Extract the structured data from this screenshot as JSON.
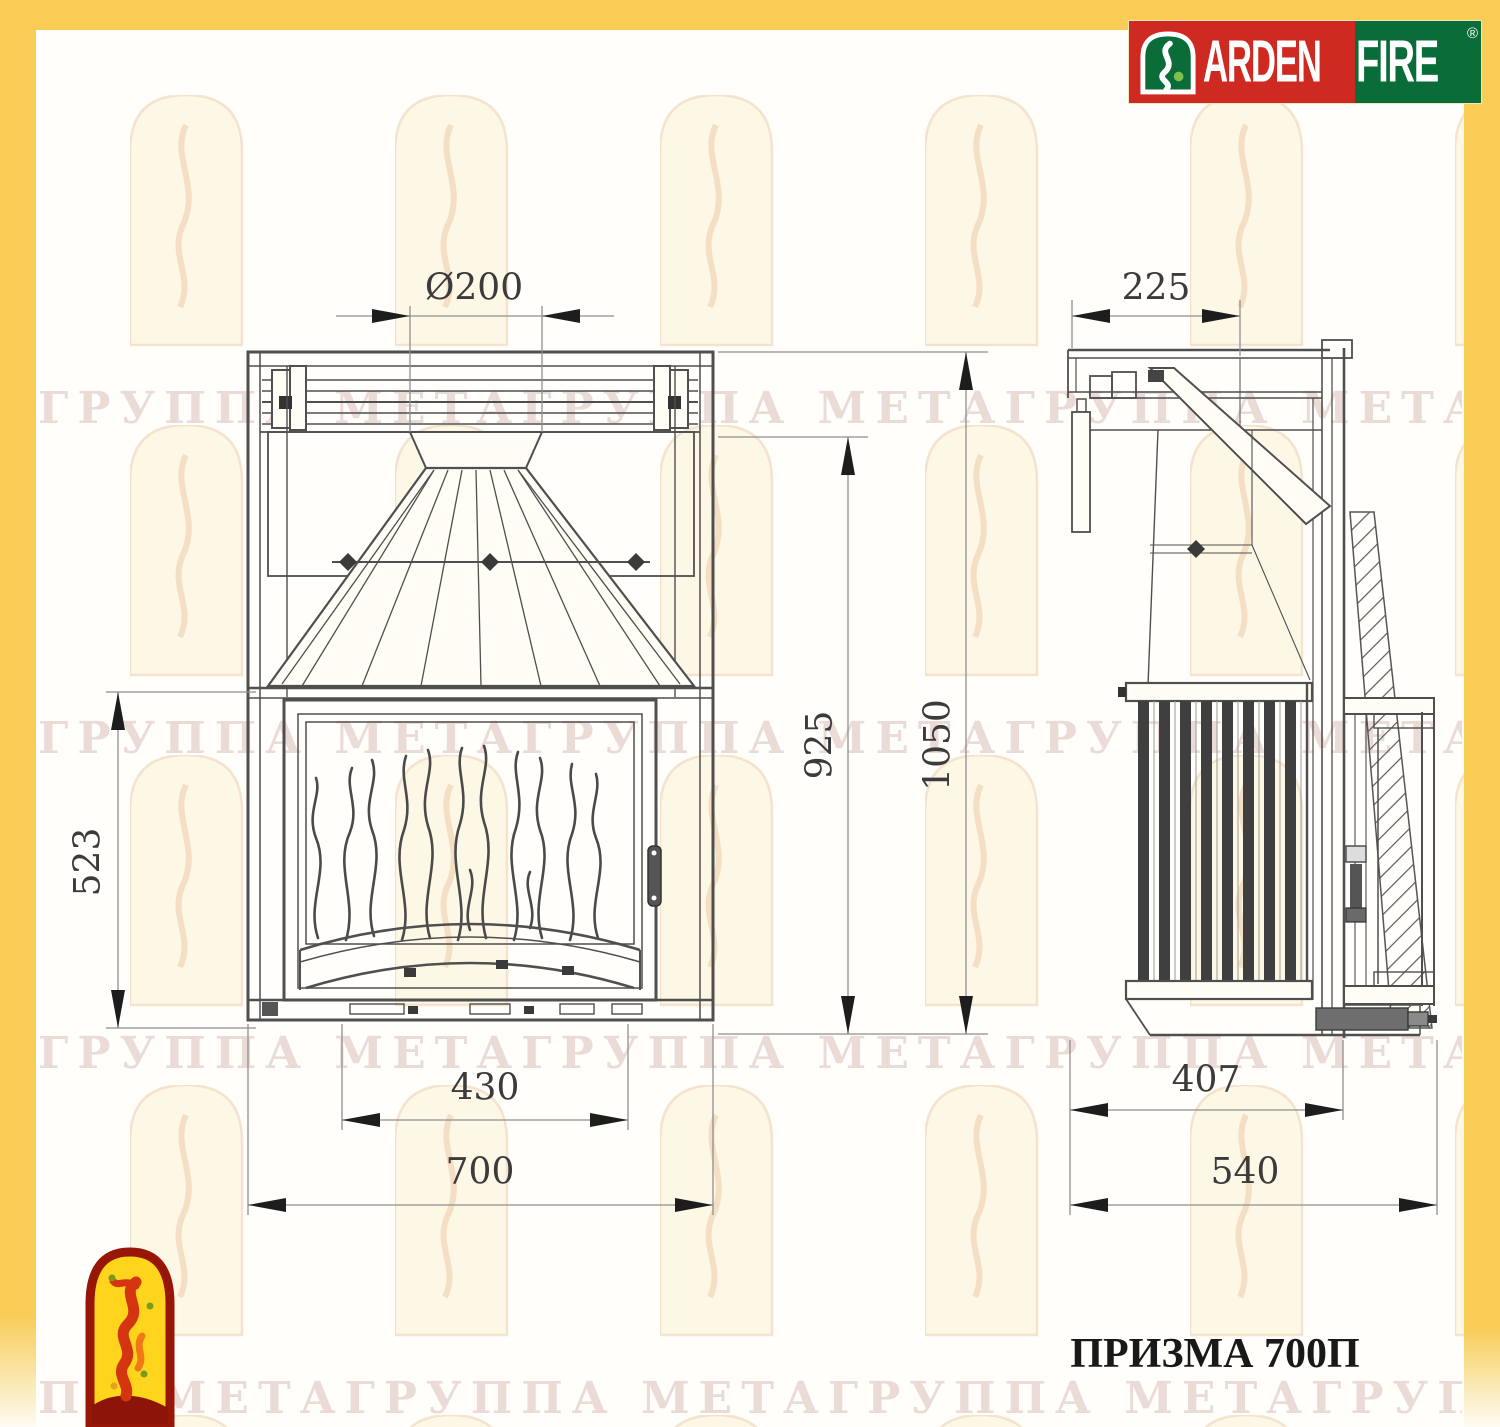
{
  "brand": {
    "left": "ARDEN",
    "right": "FIRE",
    "registered": "®"
  },
  "model": {
    "label": "ПРИЗМА 700П"
  },
  "watermark": {
    "rows": [
      "ГРУППА МЕТАГРУППА МЕТАГРУППА МЕТАГРУППА МЕТАГР",
      "ГРУППА МЕТАГРУППА МЕТАГРУППА МЕТАГРУППА МЕТАГР",
      "ГРУППА МЕТАГРУППА МЕТАГРУППА МЕТАГРУППА МЕТАГР",
      "ПА МЕТАГРУППА МЕТАГРУППА МЕТАГРУППА МЕТАГРУ"
    ]
  },
  "dimensions": {
    "front": {
      "flue_diameter": "Ø200",
      "firebox_height": "523",
      "collar_height": "925",
      "total_height": "1050",
      "opening_width": "430",
      "total_width": "700"
    },
    "side": {
      "top_depth": "225",
      "body_depth": "407",
      "total_depth": "540"
    }
  },
  "colors": {
    "frame_yellow": "#F8CC55",
    "logo_red": "#CF2A22",
    "logo_green": "#0A6C38",
    "mascot_yellow": "#FFD41C",
    "mascot_red": "#D4340F",
    "drawing_line": "#4f4f4f"
  }
}
